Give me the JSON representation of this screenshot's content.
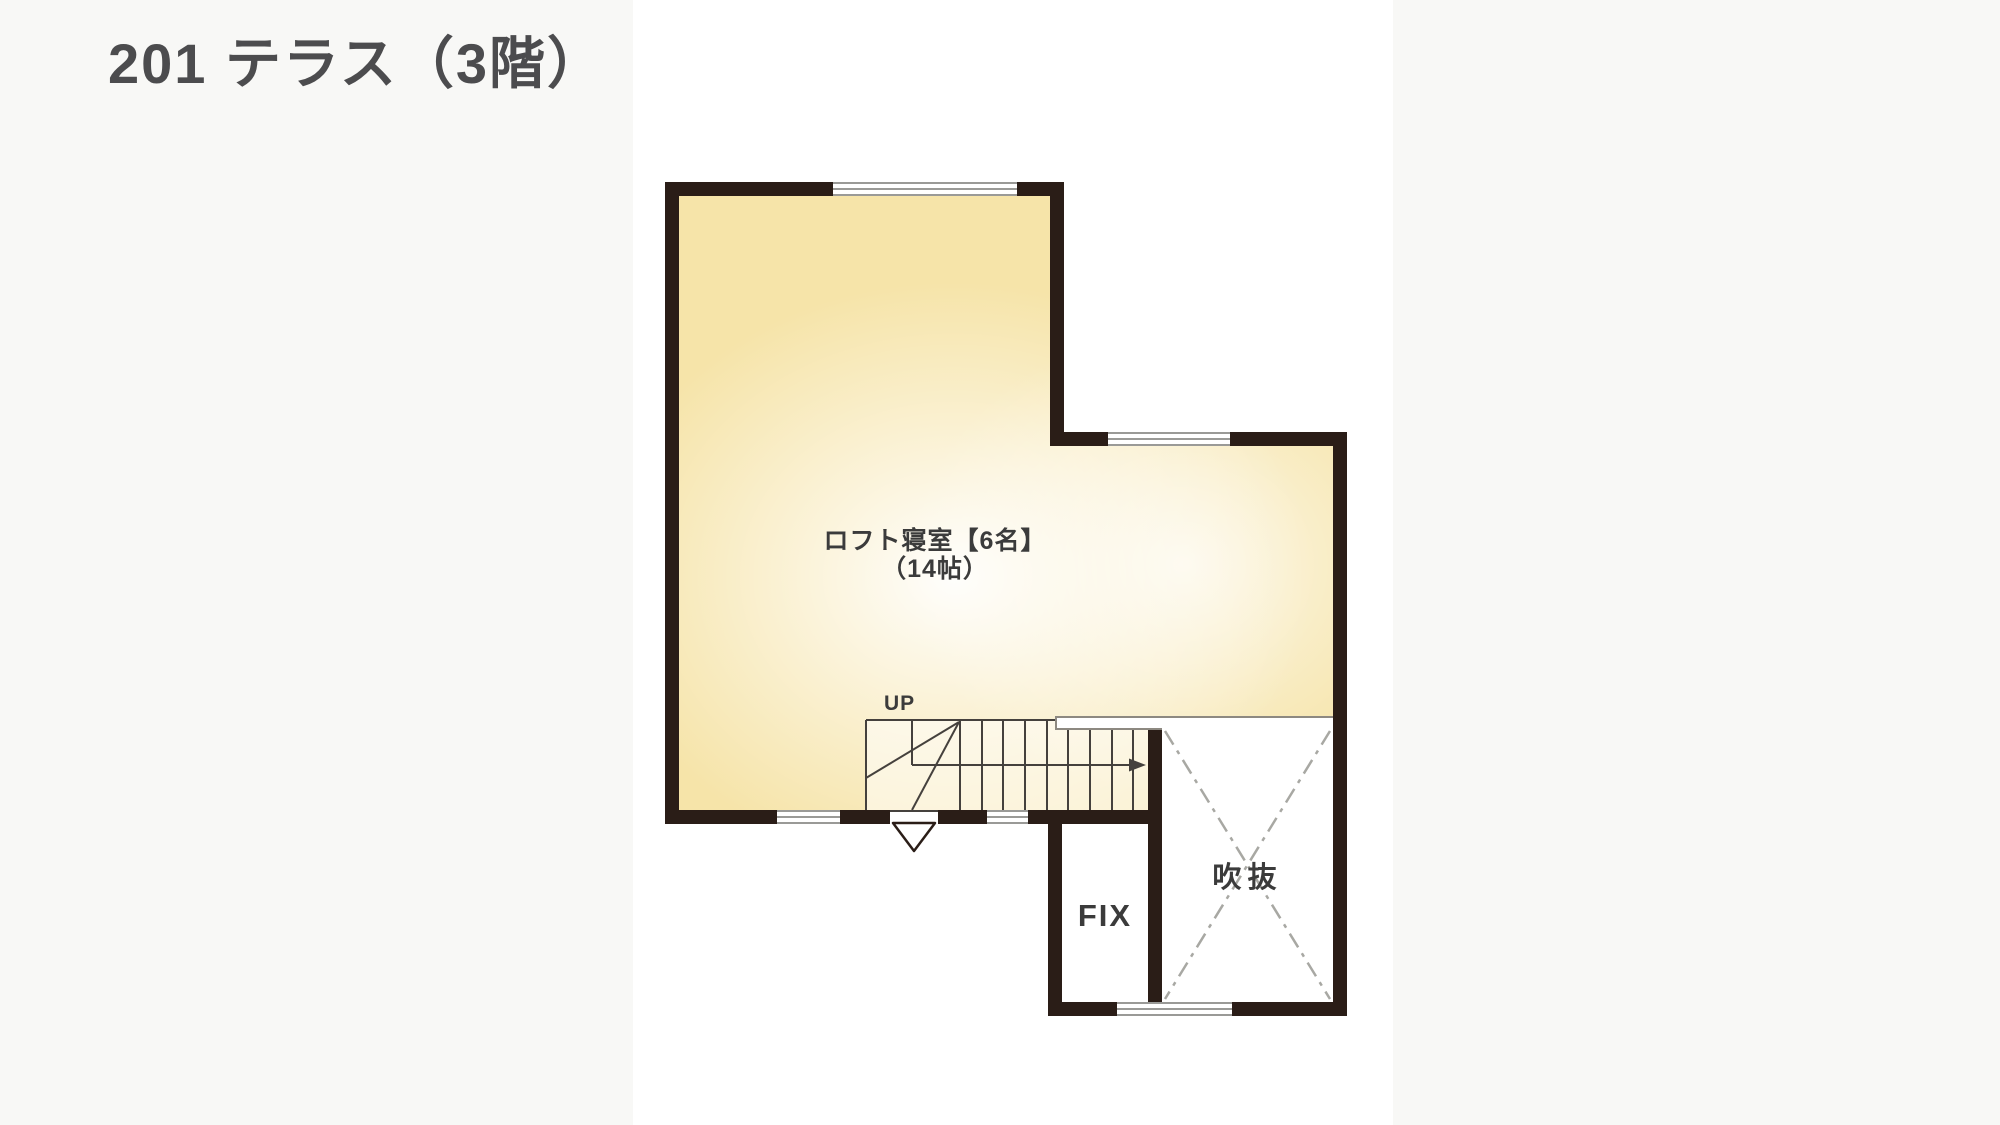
{
  "page": {
    "title": "201 テラス（3階）"
  },
  "plan": {
    "room": {
      "name": "ロフト寝室【6名】",
      "size": "（14帖）"
    },
    "stairs": {
      "direction_label": "UP"
    },
    "fix": {
      "label": "FIX"
    },
    "void": {
      "label": "吹抜"
    },
    "colors": {
      "wall": "#2a1d17",
      "room_fill": "#f6e4a9",
      "stair_line": "#45413d",
      "window_line": "#9a9a97",
      "dash_line": "#a8a8a3",
      "railing_line": "#8d8981",
      "title_text": "#4c4c4e",
      "label_text": "#3b3b3b"
    }
  }
}
